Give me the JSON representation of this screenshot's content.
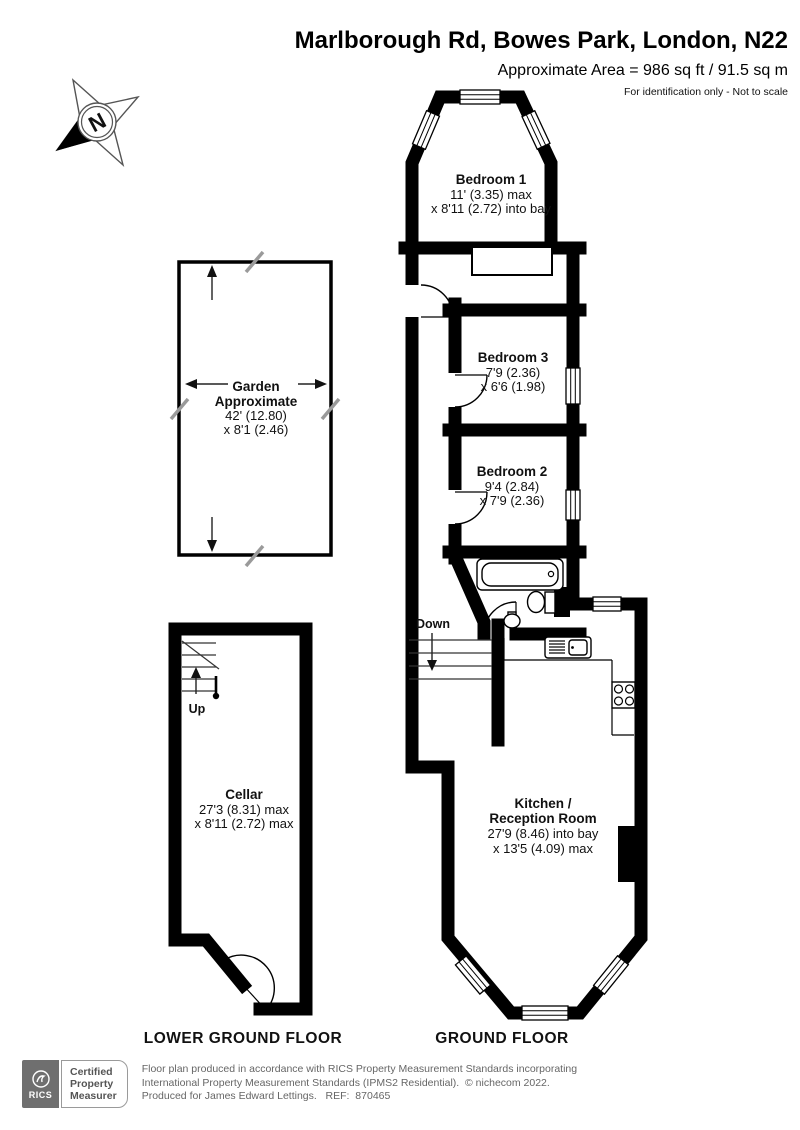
{
  "header": {
    "title": "Marlborough Rd, Bowes Park, London, N22",
    "area": "Approximate Area = 986 sq ft / 91.5 sq m",
    "disclaimer": "For identification only - Not to scale"
  },
  "compass": {
    "north": "N"
  },
  "garden": {
    "name": "Garden",
    "approx": "Approximate",
    "dim1": "42' (12.80)",
    "dim2": "x 8'1 (2.46)"
  },
  "rooms": {
    "bedroom1": {
      "name": "Bedroom 1",
      "dim1": "11' (3.35) max",
      "dim2": "x 8'11 (2.72) into bay"
    },
    "bedroom3": {
      "name": "Bedroom 3",
      "dim1": "7'9 (2.36)",
      "dim2": "x 6'6 (1.98)"
    },
    "bedroom2": {
      "name": "Bedroom 2",
      "dim1": "9'4 (2.84)",
      "dim2": "x 7'9 (2.36)"
    },
    "kitchen": {
      "name1": "Kitchen /",
      "name2": "Reception Room",
      "dim1": "27'9 (8.46) into bay",
      "dim2": "x 13'5 (4.09) max"
    },
    "cellar": {
      "name": "Cellar",
      "dim1": "27'3 (8.31) max",
      "dim2": "x 8'11 (2.72) max"
    }
  },
  "stairs": {
    "up": "Up",
    "down": "Down"
  },
  "floors": {
    "ground": "GROUND FLOOR",
    "lower": "LOWER GROUND FLOOR"
  },
  "footer": {
    "badge": {
      "org": "RICS",
      "line1": "Certified",
      "line2": "Property",
      "line3": "Measurer"
    },
    "line1": "Floor plan produced in accordance with RICS Property Measurement Standards incorporating",
    "line2": "International Property Measurement Standards (IPMS2 Residential).  © nichecom 2022.",
    "line3": "Produced for James Edward Lettings.   REF:  870465"
  },
  "colors": {
    "wall": "#000000",
    "rics_gray": "#6f6f6f",
    "footer_text": "#666666"
  }
}
